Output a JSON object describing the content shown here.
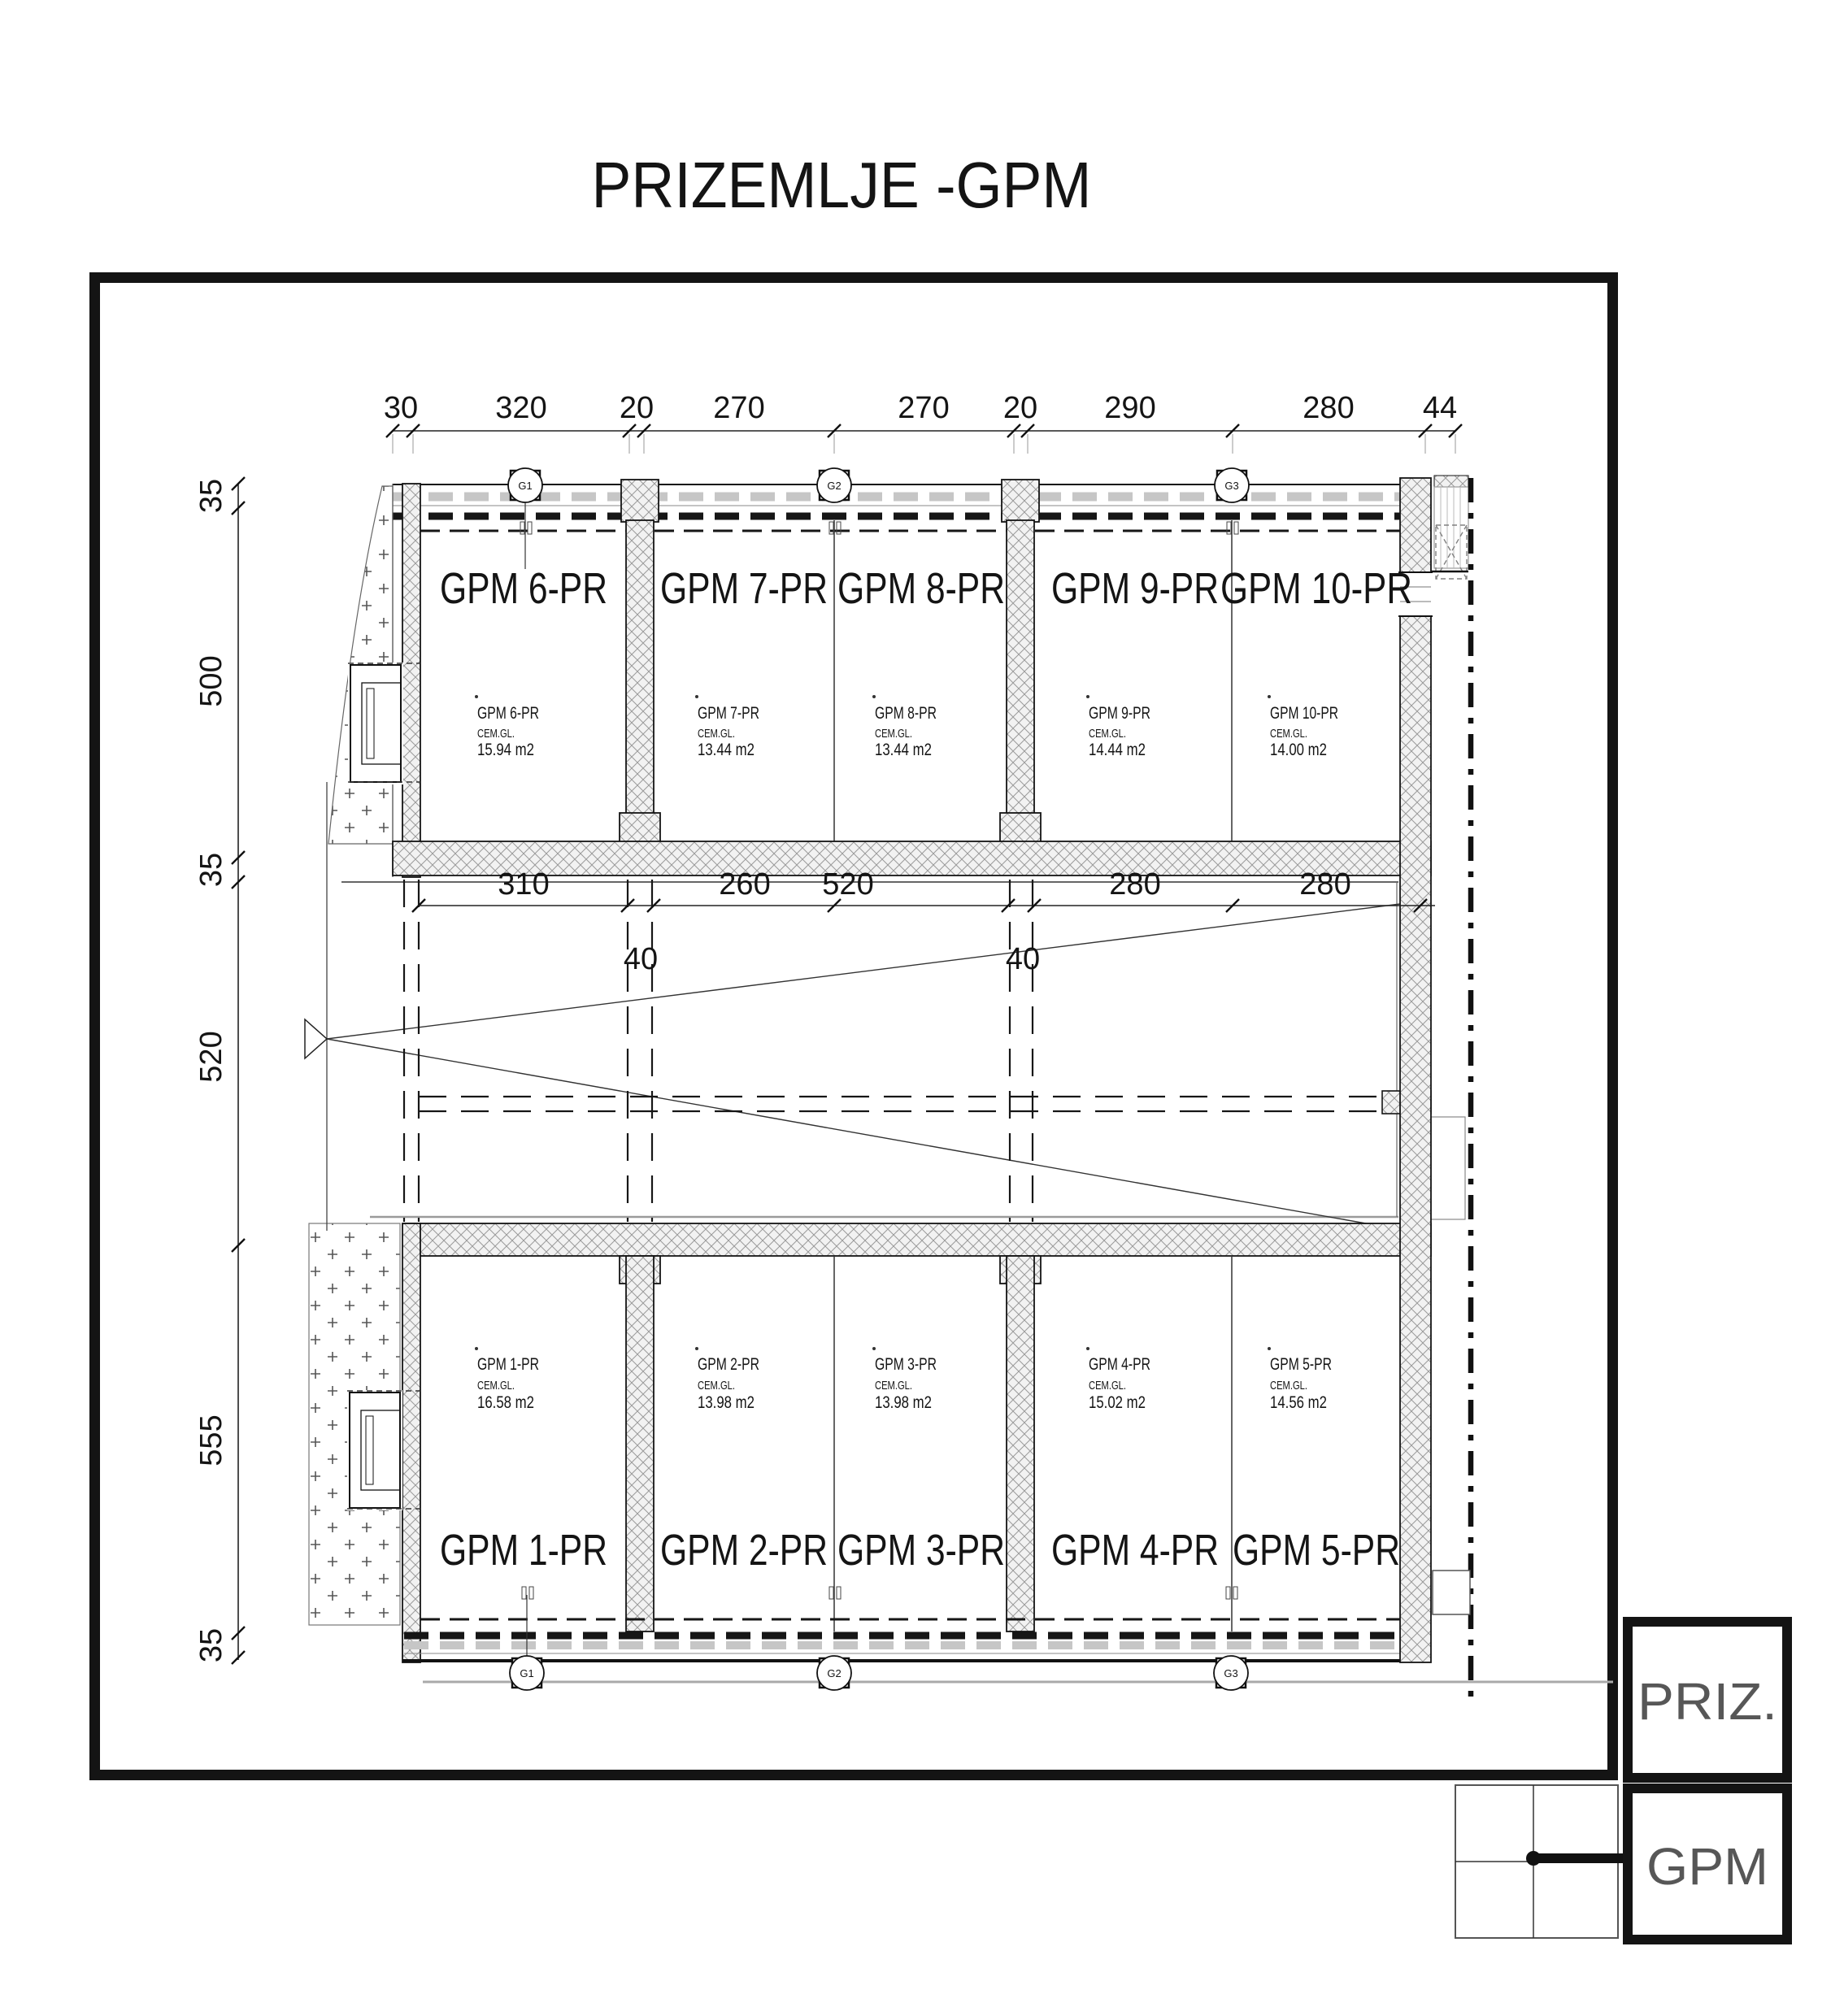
{
  "title": "PRIZEMLJE -GPM",
  "panel": {
    "floor": "PRIZ.",
    "sheet": "GPM"
  },
  "markers": {
    "g1": "G1",
    "g2": "G2",
    "g3": "G3"
  },
  "dims": {
    "top": [
      "30",
      "320",
      "20",
      "270",
      "270",
      "20",
      "290",
      "280",
      "44"
    ],
    "mid": [
      "310",
      "260",
      "520",
      "280",
      "280"
    ],
    "mid40": [
      "40",
      "40"
    ],
    "left": [
      "35",
      "500",
      "35",
      "520",
      "555",
      "35"
    ]
  },
  "units": {
    "top": [
      {
        "label": "GPM 6-PR",
        "finish": "CEM.GL.",
        "area": "15.94 m2"
      },
      {
        "label": "GPM 7-PR",
        "finish": "CEM.GL.",
        "area": "13.44 m2"
      },
      {
        "label": "GPM 8-PR",
        "finish": "CEM.GL.",
        "area": "13.44 m2"
      },
      {
        "label": "GPM 9-PR",
        "finish": "CEM.GL.",
        "area": "14.44 m2"
      },
      {
        "label": "GPM 10-PR",
        "finish": "CEM.GL.",
        "area": "14.00 m2"
      }
    ],
    "bottom": [
      {
        "label": "GPM 1-PR",
        "finish": "CEM.GL.",
        "area": "16.58 m2"
      },
      {
        "label": "GPM 2-PR",
        "finish": "CEM.GL.",
        "area": "13.98 m2"
      },
      {
        "label": "GPM 3-PR",
        "finish": "CEM.GL.",
        "area": "13.98 m2"
      },
      {
        "label": "GPM 4-PR",
        "finish": "CEM.GL.",
        "area": "15.02 m2"
      },
      {
        "label": "GPM 5-PR",
        "finish": "CEM.GL.",
        "area": "14.56 m2"
      }
    ]
  }
}
